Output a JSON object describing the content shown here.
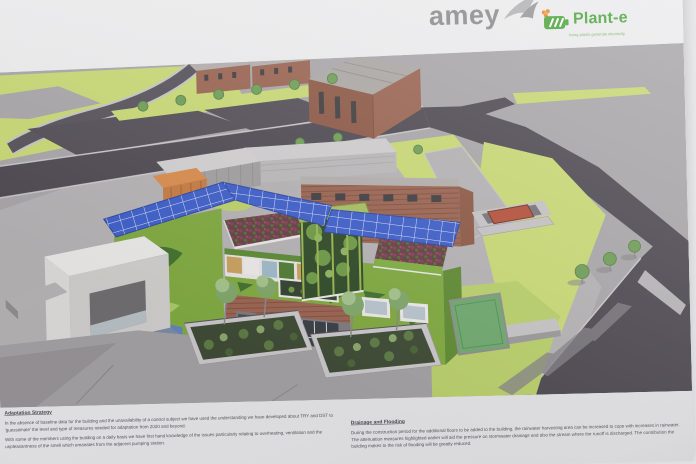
{
  "header": {
    "amey_label": "amey",
    "plante_label": "Plant-e",
    "plante_tagline": "living plants generate electricity"
  },
  "captions": {
    "left": {
      "heading": "Adaptation Strategy",
      "p1": "In the absence of baseline data for the building and the unavailability of a control subject we have used the understanding we have developed about TRY and DST to 'guesstimate' the level and type of measures needed for adaptation from 2020 and beyond.",
      "p2": "With some of the members using the building on a daily basis we have first hand knowledge of the issues particularly relating to overheating, ventilation and the unpleasantness of the smell which emanates from the adjacent pumping station."
    },
    "right": {
      "heading": "Drainage and Flooding",
      "p1": "During the construction period for the additional floors to be added to the building, the rainwater harvesting area can be increased to cope with increases in rainwater. The attenuation measures highlighted earlier will aid the pressure on stormwater drainage and also the stream where the runoff is discharged. The contribution the building makes to the risk of flooding will be greatly reduced."
    }
  },
  "colors": {
    "paper": "#ecedee",
    "ground_gray": "#a9a6a9",
    "yard_gray": "#b5b2b4",
    "road_dark": "#4e4951",
    "grass_lime": "#c9d974",
    "solar_blue": "#3d5ec9",
    "brick": "#9a6350",
    "living_wall_green": "#7fa93e",
    "sedum_red": "#6d3a47",
    "pond_green": "#6fa86d",
    "amey_gray": "#8b8b8d",
    "plante_green": "#4ba53c",
    "container_orange": "#c67a40",
    "skip_red": "#b5503a"
  }
}
